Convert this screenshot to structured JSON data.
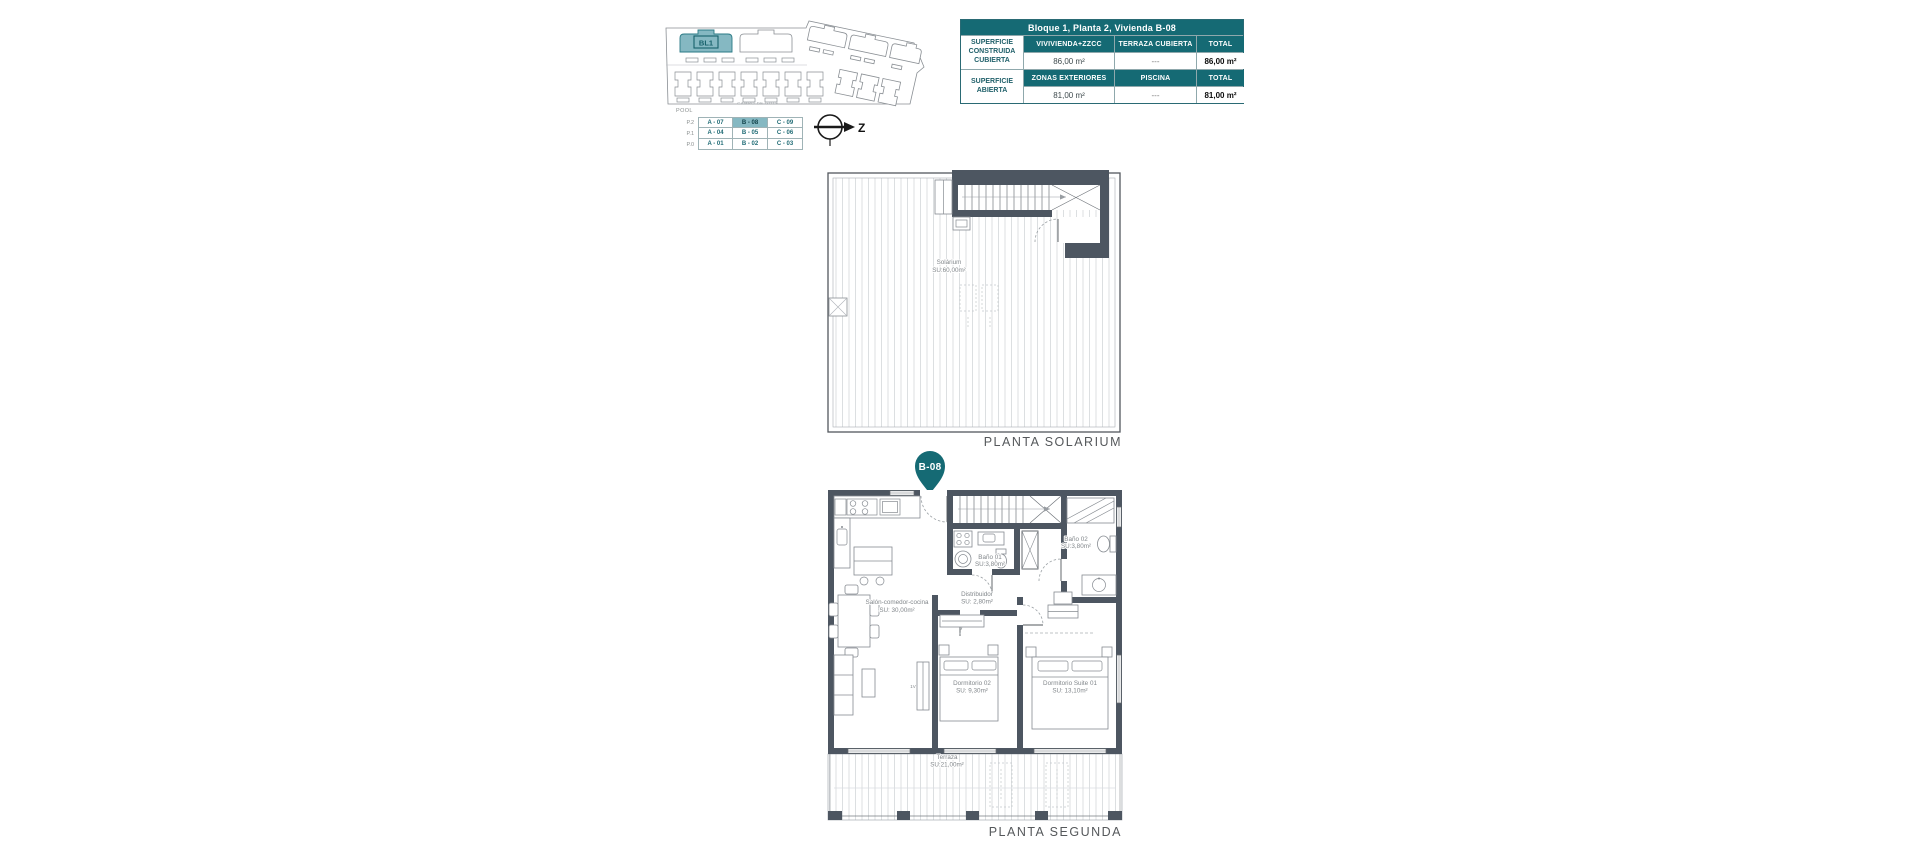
{
  "colors": {
    "teal": "#156a74",
    "teal_light": "#85b8c2",
    "wall": "#4d5661"
  },
  "site_plan": {
    "block_label": "BL1",
    "caption": "CAMPO DE GOLF"
  },
  "unit_table": {
    "pool_label": "POOL",
    "rows": [
      {
        "level": "P.2",
        "cells": [
          "A - 07",
          "B - 08",
          "C - 09"
        ]
      },
      {
        "level": "P.1",
        "cells": [
          "A - 04",
          "B - 05",
          "C - 06"
        ]
      },
      {
        "level": "P.0",
        "cells": [
          "A - 01",
          "B - 02",
          "C - 03"
        ]
      }
    ],
    "highlighted_cell": "B - 08"
  },
  "compass": {
    "label": "Z"
  },
  "surface_table": {
    "title": "Bloque 1, Planta 2, Vivienda B-08",
    "sections": [
      {
        "row_label": "SUPERFICIE CONSTRUIDA CUBIERTA",
        "columns": [
          "VIVIVIENDA+ZZCC",
          "TERRAZA CUBIERTA",
          "TOTAL"
        ],
        "values": [
          "86,00 m²",
          "---",
          "86,00 m²"
        ]
      },
      {
        "row_label": "SUPERFICIE ABIERTA",
        "columns": [
          "ZONAS EXTERIORES",
          "PISCINA",
          "TOTAL"
        ],
        "values": [
          "81,00 m²",
          "---",
          "81,00 m²"
        ]
      }
    ]
  },
  "solarium": {
    "caption": "PLANTA SOLARIUM",
    "room": {
      "name": "Solárium",
      "area": "SU:60,00m²"
    }
  },
  "segunda": {
    "caption": "PLANTA SEGUNDA",
    "pin": "B-08",
    "window_label": "1V",
    "rooms": {
      "salon": {
        "name": "Salón-comedor-cocina",
        "area": "SU: 30,00m²"
      },
      "distribuidor": {
        "name": "Distribuidor",
        "area": "SU: 2,80m²"
      },
      "bano1": {
        "name": "Baño 01",
        "area": "SU:3,80m²"
      },
      "bano2": {
        "name": "Baño 02",
        "area": "SU:3,80m²"
      },
      "dorm2": {
        "name": "Dormitorio 02",
        "area": "SU: 9,30m²"
      },
      "suite": {
        "name": "Dormitorio Suite 01",
        "area": "SU: 13,10m²"
      },
      "terraza": {
        "name": "Terraza",
        "area": "SU:21,00m²"
      }
    }
  }
}
